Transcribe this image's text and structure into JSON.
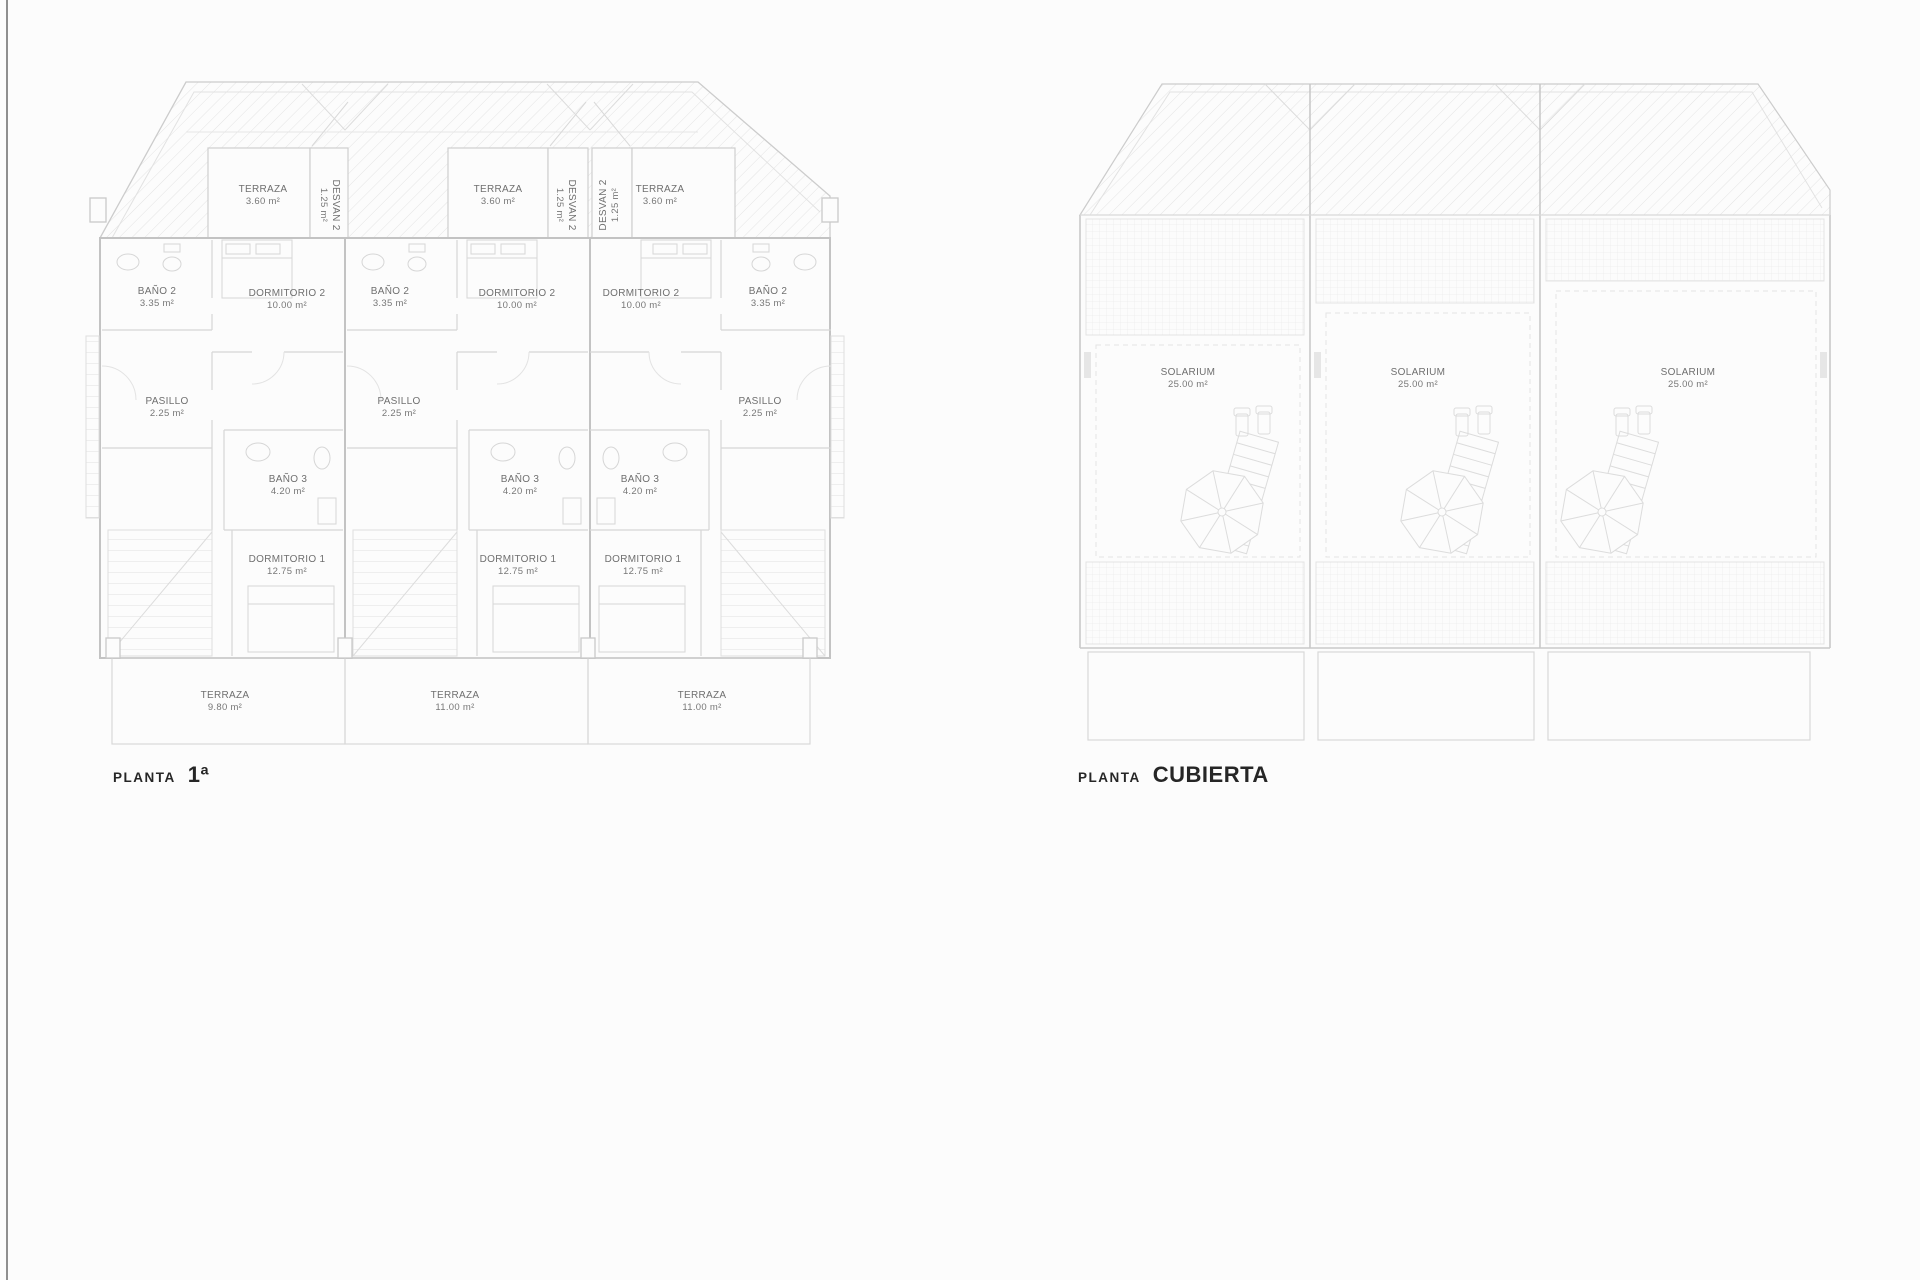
{
  "sheet": {
    "background_color": "#fcfcfc",
    "frame_line_color": "#8f8f8f",
    "linework_color": "#d6d6d6",
    "label_color": "#6f6f6f",
    "title_color": "#262626"
  },
  "plan_primera": {
    "title_prefix": "PLANTA",
    "title_name": "1ª",
    "rooms": {
      "terraza_atico": {
        "name": "TERRAZA",
        "area": "3.60 m²"
      },
      "desvan2": {
        "name": "DESVAN 2",
        "area": "1.25 m²"
      },
      "bano2": {
        "name": "BAÑO 2",
        "area": "3.35 m²"
      },
      "dormitorio2": {
        "name": "DORMITORIO 2",
        "area": "10.00 m²"
      },
      "pasillo": {
        "name": "PASILLO",
        "area": "2.25 m²"
      },
      "bano3": {
        "name": "BAÑO 3",
        "area": "4.20 m²"
      },
      "dormitorio1": {
        "name": "DORMITORIO 1",
        "area": "12.75 m²"
      },
      "terraza_u1": {
        "name": "TERRAZA",
        "area": "9.80 m²"
      },
      "terraza_u2": {
        "name": "TERRAZA",
        "area": "11.00 m²"
      },
      "terraza_u3": {
        "name": "TERRAZA",
        "area": "11.00 m²"
      }
    }
  },
  "plan_cubierta": {
    "title_prefix": "PLANTA",
    "title_name": "CUBIERTA",
    "rooms": {
      "solarium": {
        "name": "SOLARIUM",
        "area": "25.00 m²"
      }
    }
  }
}
